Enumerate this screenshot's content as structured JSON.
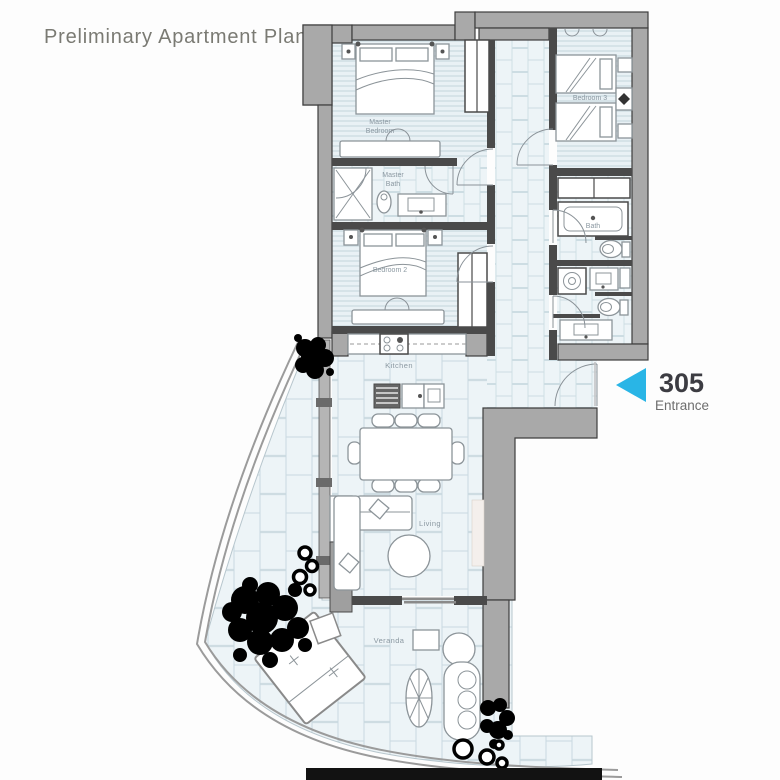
{
  "title": "Preliminary Apartment Plan",
  "entrance": {
    "unit_number": "305",
    "label": "Entrance"
  },
  "rooms": {
    "master_l1": "Master",
    "master_l2": "Bedroom",
    "mbath_l1": "Master",
    "mbath_l2": "Bath",
    "bedroom2": "Bedroom 2",
    "bedroom3": "Bedroom 3",
    "bath": "Bath",
    "kitchen": "Kitchen",
    "living": "Living",
    "veranda": "Veranda"
  },
  "colors": {
    "accent_arrow": "#29b5e6",
    "unit_number_text": "#3c3c42",
    "entrance_text": "#6e6e6e",
    "title_text": "#7a7a73",
    "wall_gray": "#a9a9a9",
    "partition_dark": "#4a4a4a",
    "floor_tint": "#eaf2f6",
    "tile_line": "#c9d9e0",
    "plant": "#000000"
  }
}
